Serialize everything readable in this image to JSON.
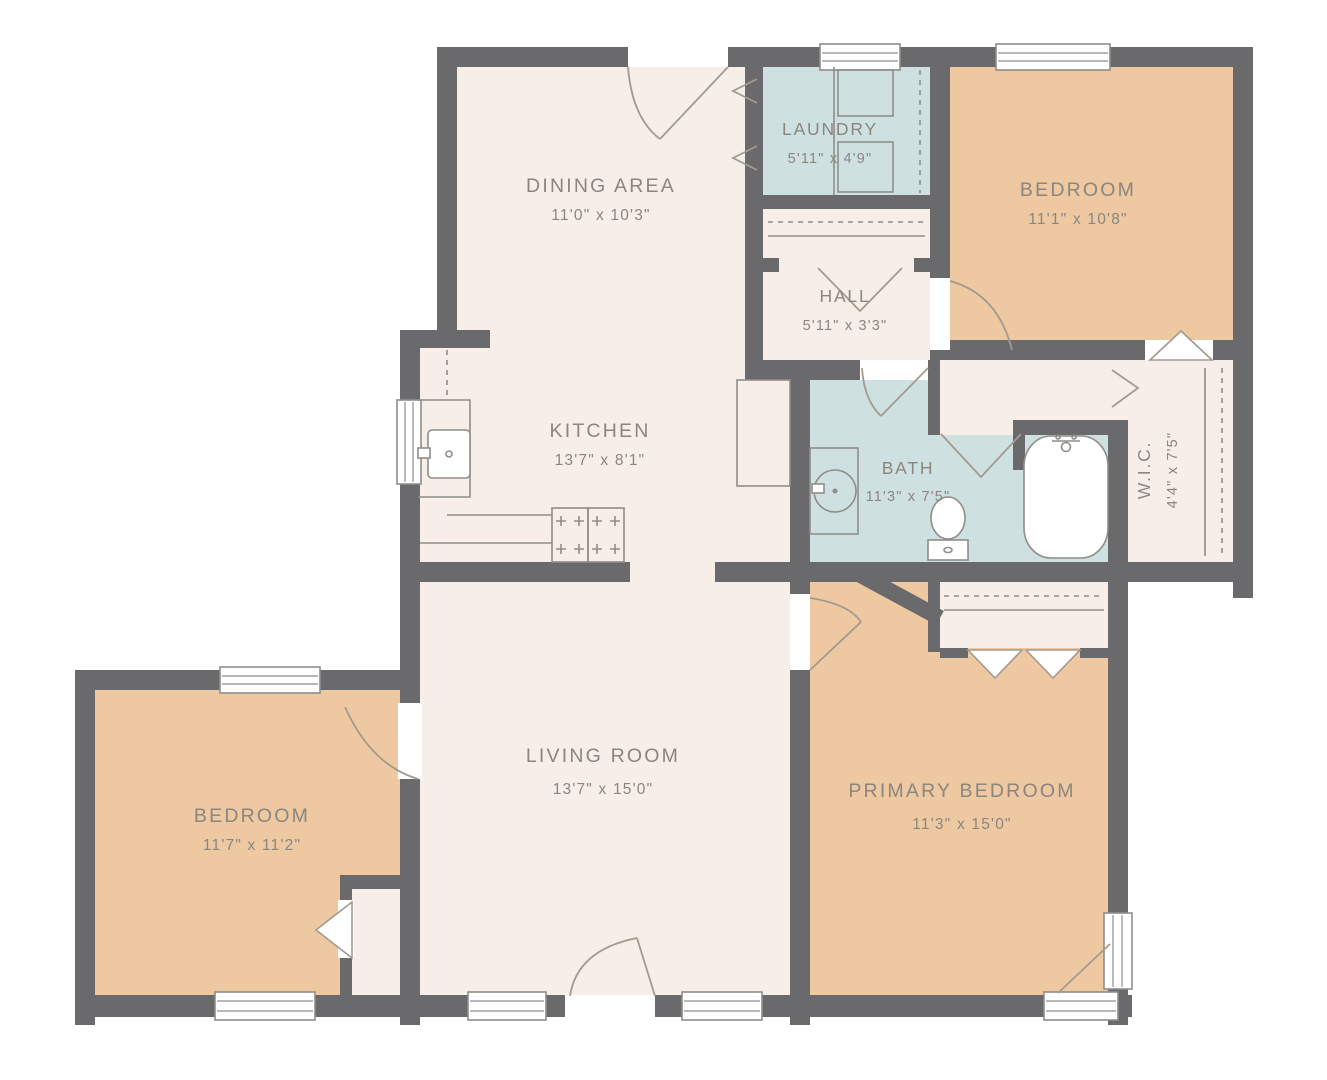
{
  "palette": {
    "wall": "#6a6a6d",
    "floor": "#f6eee7",
    "bedroom_floor": "#edc8a0",
    "wet_floor": "#cfe0e1",
    "fixture_line": "#8f8d8a",
    "door_line": "#a39a91",
    "label_text": "#8a8680",
    "background": "#ffffff"
  },
  "rooms": {
    "dining": {
      "name": "DINING AREA",
      "dims": "11'0\" x 10'3\""
    },
    "laundry": {
      "name": "LAUNDRY",
      "dims": "5'11\" x 4'9\""
    },
    "bedroom_top": {
      "name": "BEDROOM",
      "dims": "11'1\" x 10'8\""
    },
    "hall": {
      "name": "HALL",
      "dims": "5'11\" x 3'3\""
    },
    "kitchen": {
      "name": "KITCHEN",
      "dims": "13'7\" x 8'1\""
    },
    "bath": {
      "name": "BATH",
      "dims": "11'3\" x 7'5\""
    },
    "wic": {
      "name": "W.I.C.",
      "dims": "4'4\" x 7'5\""
    },
    "living": {
      "name": "LIVING ROOM",
      "dims": "13'7\" x 15'0\""
    },
    "bedroom_left": {
      "name": "BEDROOM",
      "dims": "11'7\" x 11'2\""
    },
    "primary": {
      "name": "PRIMARY BEDROOM",
      "dims": "11'3\" x 15'0\""
    }
  }
}
